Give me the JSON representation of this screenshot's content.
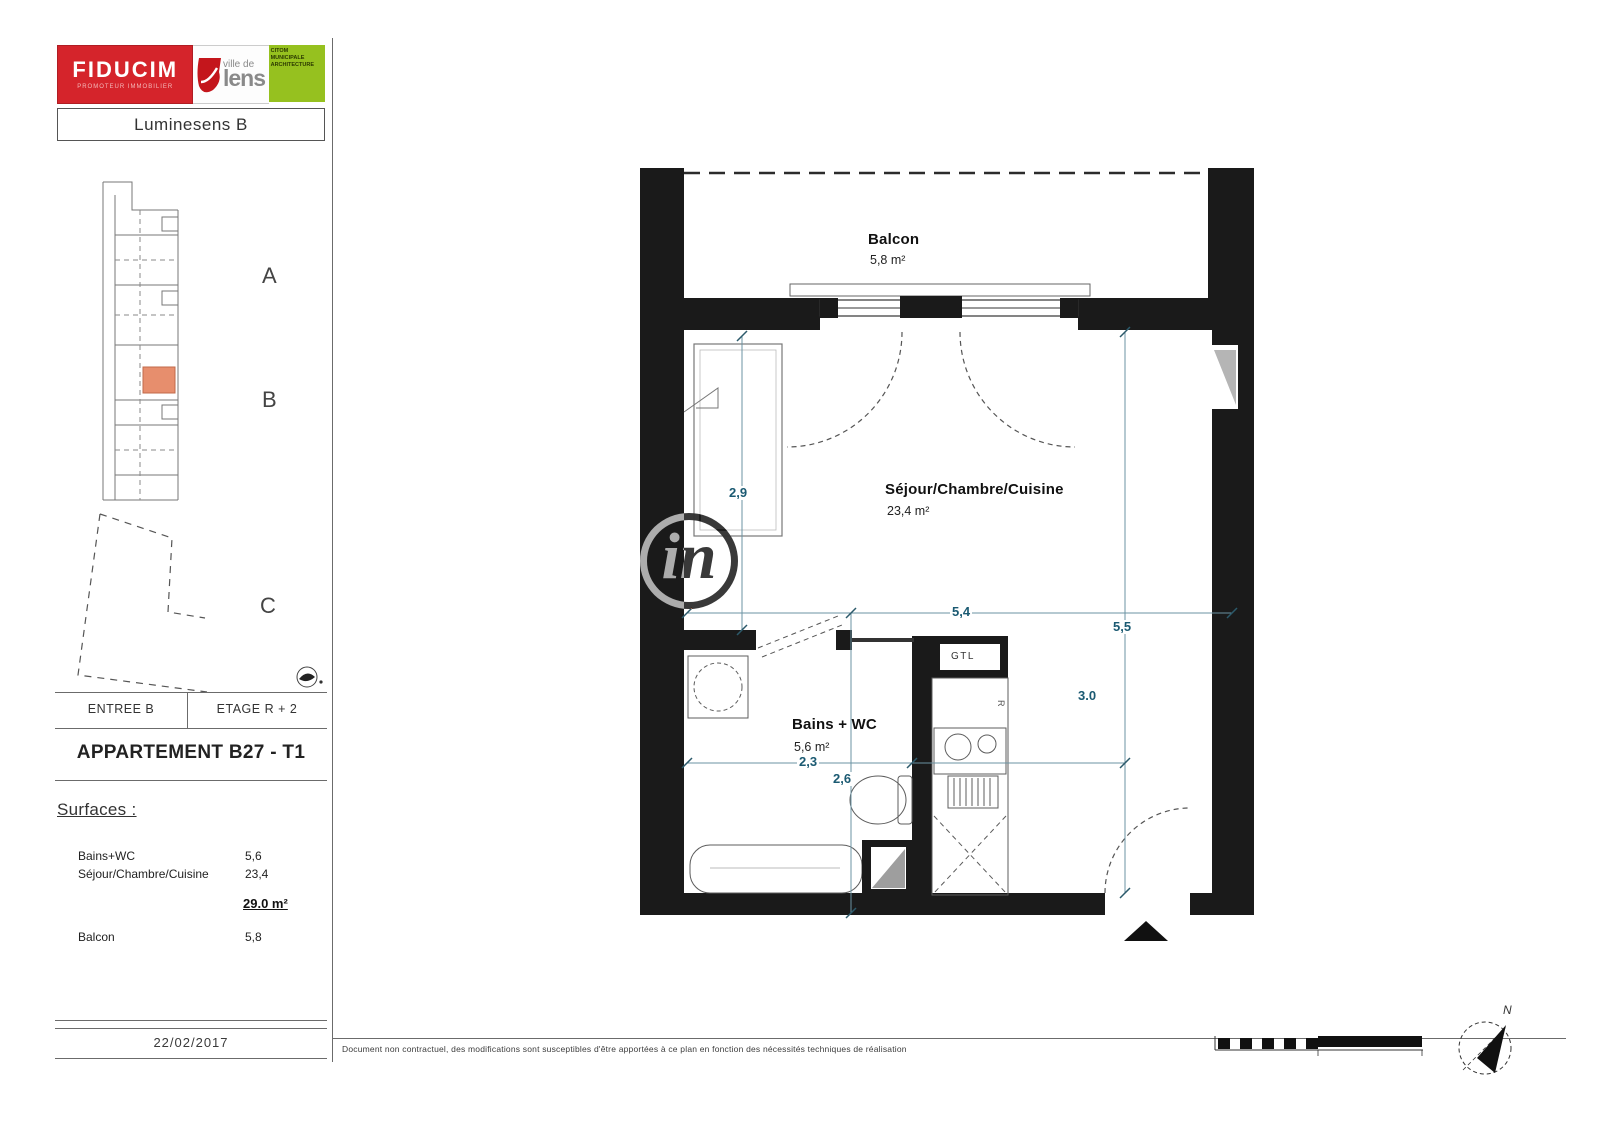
{
  "header": {
    "fiducim": {
      "name": "FIDUCIM",
      "tagline": "PROMOTEUR IMMOBILIER"
    },
    "lens": {
      "top": "ville de",
      "bottom": "lens"
    },
    "architect": {
      "line1": "CITOM",
      "line2": "MUNICIPALE",
      "line3": "ARCHITECTURE"
    },
    "residence": "Luminesens B"
  },
  "keyplan": {
    "label_a": "A",
    "label_b": "B",
    "label_c": "C"
  },
  "info_bar": {
    "entree": "ENTREE B",
    "etage": "ETAGE R + 2"
  },
  "apartment": {
    "title": "APPARTEMENT B27 - T1"
  },
  "surfaces": {
    "heading": "Surfaces :",
    "rows": [
      {
        "label": "Bains+WC",
        "value": "5,6"
      },
      {
        "label": "Séjour/Chambre/Cuisine",
        "value": "23,4"
      }
    ],
    "total": "29.0 m²",
    "extra_label": "Balcon",
    "extra_value": "5,8"
  },
  "plan": {
    "balcon_name": "Balcon",
    "balcon_area": "5,8 m²",
    "sejour_name": "Séjour/Chambre/Cuisine",
    "sejour_area": "23,4 m²",
    "bains_name": "Bains + WC",
    "bains_area": "5,6 m²",
    "gtl": "GTL",
    "fridge_label": "R",
    "dims": {
      "closet_height": "2,9",
      "room_width": "5,4",
      "room_height": "5,5",
      "inner_height": "3.0",
      "bath_width": "2,3",
      "bath_height": "2,6"
    },
    "north": "N"
  },
  "footer": {
    "date": "22/02/2017",
    "disclaimer": "Document non contractuel, des modifications sont susceptibles d'être apportées à ce plan en fonction des nécessités techniques de réalisation"
  },
  "watermark": "in",
  "colors": {
    "brand_red": "#d5242b",
    "brand_green": "#96c11f",
    "unit_highlight": "#e78e6d",
    "dimension": "#1b5a72",
    "wall": "#1a1a1a"
  }
}
